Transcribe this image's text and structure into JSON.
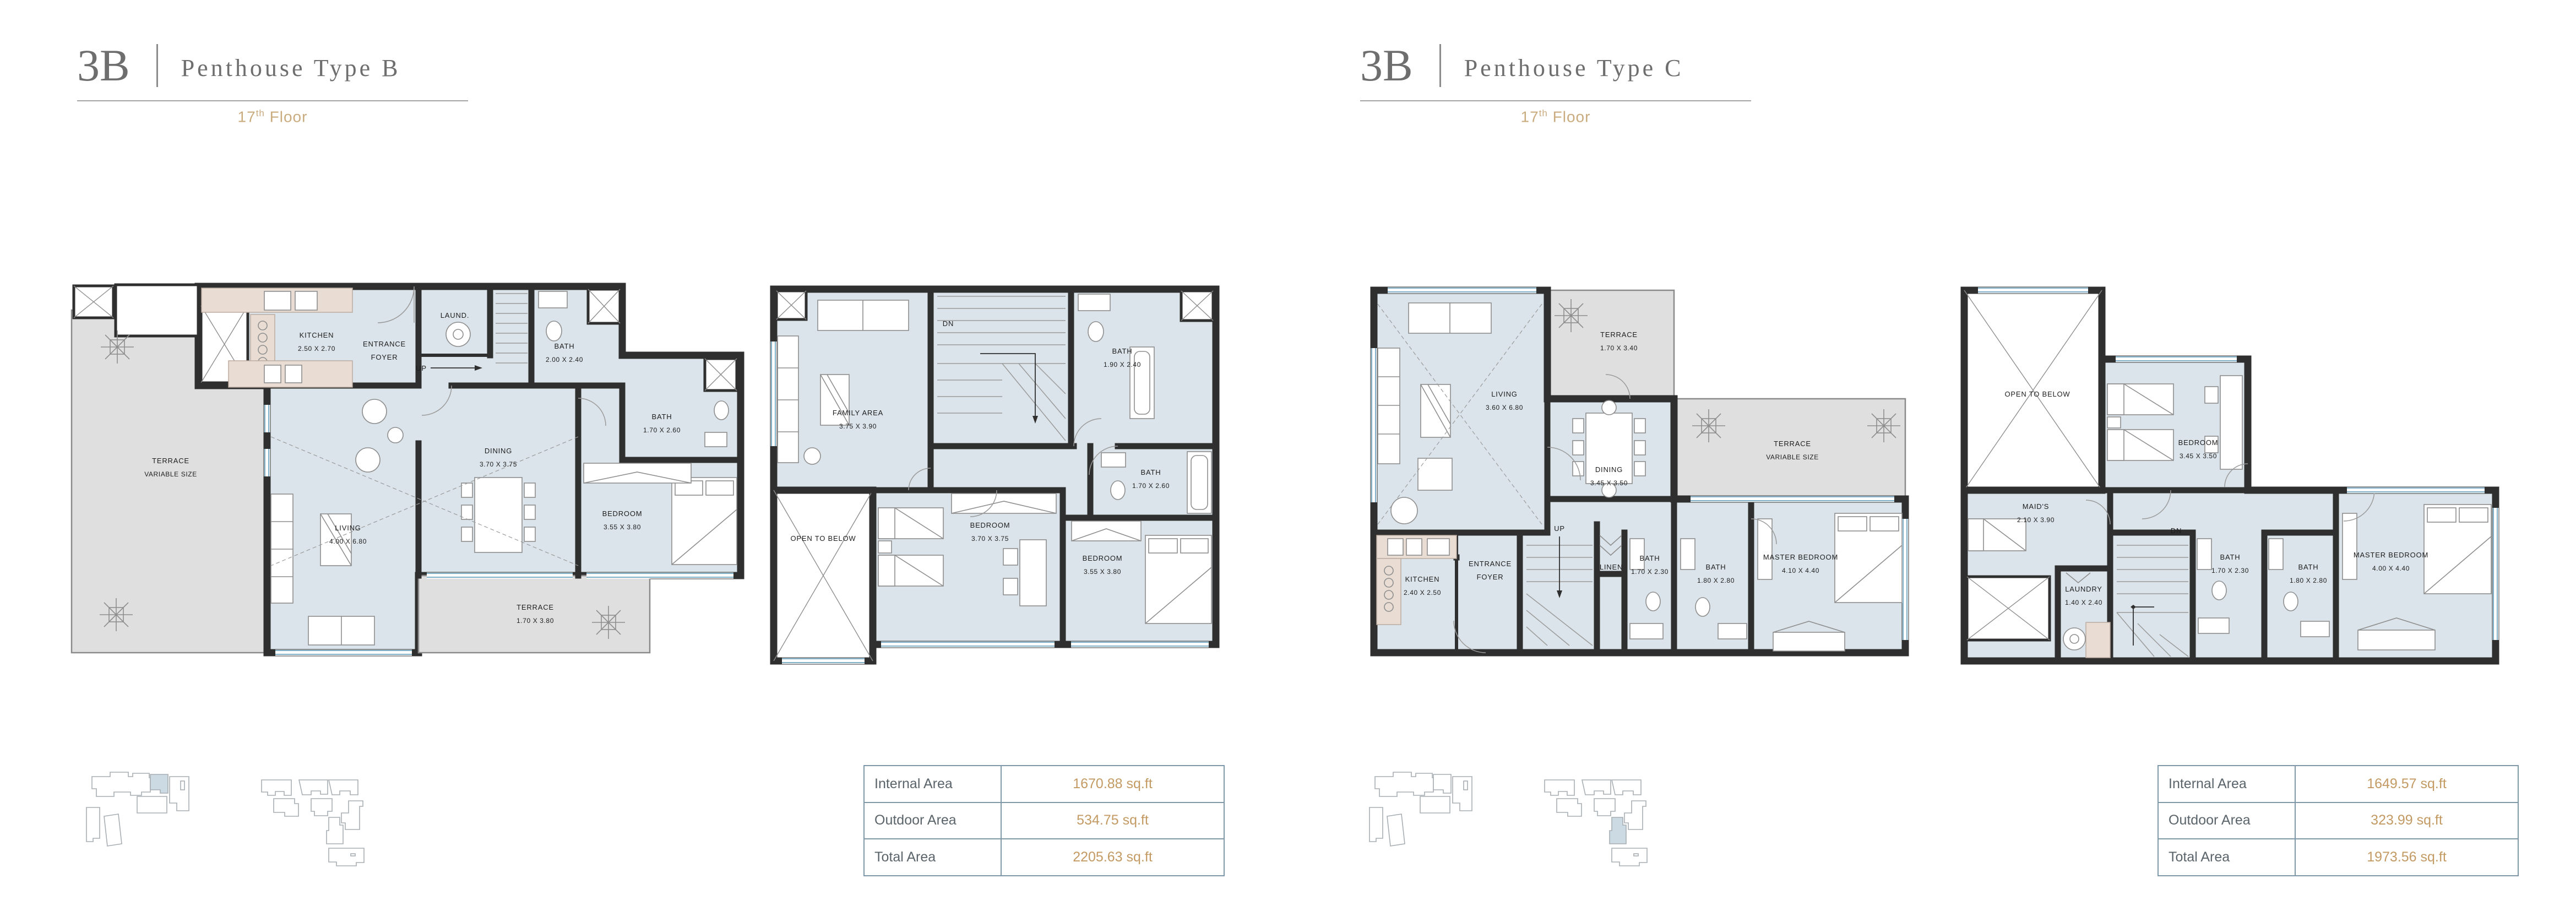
{
  "colors": {
    "accent_gold": "#c49a63",
    "floor_gold": "#c9ab7e",
    "title_gray": "#6e6e6e",
    "floor_fill": "#dbe4ea",
    "terrace_fill": "#dfdfdf",
    "wall": "#2f2f2f",
    "counter_fill": "#e8dcd3",
    "table_border": "#7e98a8",
    "keyplan_highlight": "#ccdbe3"
  },
  "units": [
    {
      "code": "3B",
      "title": "Penthouse Type B",
      "floor_num": "17",
      "floor_sup": "th",
      "floor_word": "Floor",
      "table": {
        "rows": [
          {
            "label": "Internal Area",
            "value": "1670.88 sq.ft"
          },
          {
            "label": "Outdoor Area",
            "value": "534.75 sq.ft"
          },
          {
            "label": "Total Area",
            "value": "2205.63 sq.ft"
          }
        ]
      },
      "plans": [
        {
          "rooms": [
            {
              "l1": "KITCHEN",
              "l2": "2.50 X 2.70"
            },
            {
              "l1": "ENTRANCE",
              "l2": "FOYER"
            },
            {
              "l1": "LAUND."
            },
            {
              "l1": "UP"
            },
            {
              "l1": "BATH",
              "l2": "2.00 X 2.40"
            },
            {
              "l1": "BATH",
              "l2": "1.70 X 2.60"
            },
            {
              "l1": "DINING",
              "l2": "3.70 X 3.75"
            },
            {
              "l1": "BEDROOM",
              "l2": "3.55 X 3.80"
            },
            {
              "l1": "LIVING",
              "l2": "4.00 X 6.80"
            },
            {
              "l1": "TERRACE",
              "l2": "VARIABLE SIZE"
            },
            {
              "l1": "TERRACE",
              "l2": "1.70 X 3.80"
            }
          ]
        },
        {
          "rooms": [
            {
              "l1": "FAMILY AREA",
              "l2": "3.75 X 3.90"
            },
            {
              "l1": "DN"
            },
            {
              "l1": "BATH",
              "l2": "1.90 X 2.40"
            },
            {
              "l1": "BATH",
              "l2": "1.70 X 2.60"
            },
            {
              "l1": "OPEN TO BELOW"
            },
            {
              "l1": "BEDROOM",
              "l2": "3.70 X 3.75"
            },
            {
              "l1": "BEDROOM",
              "l2": "3.55 X 3.80"
            }
          ]
        }
      ]
    },
    {
      "code": "3B",
      "title": "Penthouse Type C",
      "floor_num": "17",
      "floor_sup": "th",
      "floor_word": "Floor",
      "table": {
        "rows": [
          {
            "label": "Internal Area",
            "value": "1649.57 sq.ft"
          },
          {
            "label": "Outdoor Area",
            "value": "323.99 sq.ft"
          },
          {
            "label": "Total Area",
            "value": "1973.56 sq.ft"
          }
        ]
      },
      "plans": [
        {
          "rooms": [
            {
              "l1": "LIVING",
              "l2": "3.60 X 6.80"
            },
            {
              "l1": "TERRACE",
              "l2": "1.70 X 3.40"
            },
            {
              "l1": "DINING",
              "l2": "3.45 X 3.50"
            },
            {
              "l1": "TERRACE",
              "l2": "VARIABLE SIZE"
            },
            {
              "l1": "KITCHEN",
              "l2": "2.40 X 2.50"
            },
            {
              "l1": "ENTRANCE",
              "l2": "FOYER"
            },
            {
              "l1": "UP"
            },
            {
              "l1": "LINEN"
            },
            {
              "l1": "BATH",
              "l2": "1.70 X 2.30"
            },
            {
              "l1": "BATH",
              "l2": "1.80 X 2.80"
            },
            {
              "l1": "MASTER BEDROOM",
              "l2": "4.10 X 4.40"
            }
          ]
        },
        {
          "rooms": [
            {
              "l1": "OPEN TO BELOW"
            },
            {
              "l1": "BEDROOM",
              "l2": "3.45 X 3.50"
            },
            {
              "l1": "MAID'S",
              "l2": "2.10 X 3.90"
            },
            {
              "l1": "DN"
            },
            {
              "l1": "LAUNDRY",
              "l2": "1.40 X 2.40"
            },
            {
              "l1": "BATH",
              "l2": "1.70 X 2.30"
            },
            {
              "l1": "BATH",
              "l2": "1.80 X 2.80"
            },
            {
              "l1": "MASTER BEDROOM",
              "l2": "4.00 X 4.40"
            }
          ]
        }
      ]
    }
  ]
}
